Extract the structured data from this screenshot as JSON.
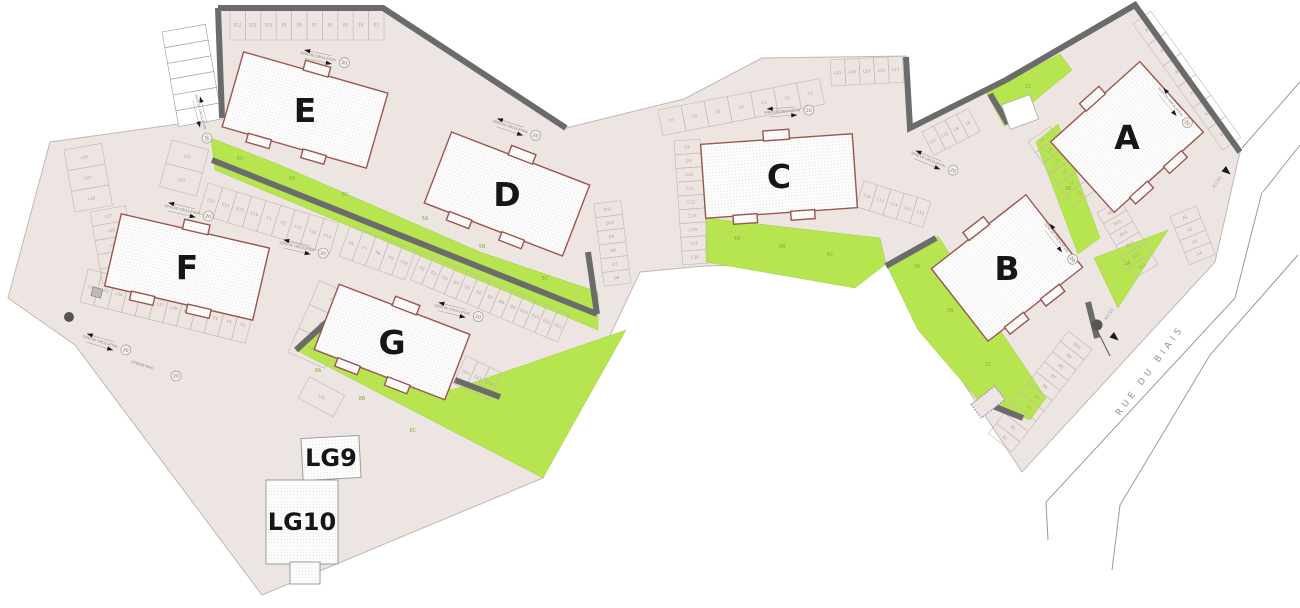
{
  "plan": {
    "street_name": "RUE DU BIAIS",
    "circulation_label": "SENS DE CIRCULATION",
    "speed_limit": "20",
    "speed_note": "VITESSE MAXI",
    "access_label": "ACCES",
    "buildings": [
      {
        "id": "E",
        "label": "E"
      },
      {
        "id": "D",
        "label": "D"
      },
      {
        "id": "F",
        "label": "F"
      },
      {
        "id": "G",
        "label": "G"
      },
      {
        "id": "C",
        "label": "C"
      },
      {
        "id": "B",
        "label": "B"
      },
      {
        "id": "A",
        "label": "A"
      },
      {
        "id": "LG9",
        "label": "LG9"
      },
      {
        "id": "LG10",
        "label": "LG10"
      }
    ],
    "green_zones": [
      "6A",
      "6B",
      "6C",
      "5A",
      "5B",
      "5C",
      "8A",
      "8B",
      "8C",
      "4A",
      "4B",
      "4C",
      "3A",
      "3B",
      "3C",
      "2C",
      "2B",
      "2A"
    ],
    "parking_rows": [
      {
        "name": "row-e-top",
        "labels": [
          "E12",
          "E11",
          "E10",
          "E9",
          "E8",
          "E7",
          "E6",
          "E5",
          "E4",
          "E3"
        ]
      },
      {
        "name": "row-visitor-white",
        "labels": [
          "",
          "",
          "",
          "",
          "",
          ""
        ]
      },
      {
        "name": "row-l22",
        "labels": [
          "L22",
          "L23"
        ]
      },
      {
        "name": "row-l24",
        "labels": [
          "L24",
          "L25",
          "L26"
        ]
      },
      {
        "name": "row-l27",
        "labels": [
          "L27",
          "L28",
          "L29",
          "L30",
          "L31"
        ]
      },
      {
        "name": "row-f-south",
        "labels": [
          "L32",
          "L33",
          "L34",
          "L35",
          "L36",
          "L37",
          "L38",
          "L39",
          "L40",
          "F5",
          "F4",
          "F3"
        ]
      },
      {
        "name": "row-ef",
        "labels": [
          "E13",
          "E14",
          "E15",
          "E16",
          "F1",
          "F2",
          "F11",
          "F12",
          "F13"
        ]
      },
      {
        "name": "row-f-mid",
        "labels": [
          "F6",
          "F7",
          "F8",
          "F9",
          "F10"
        ]
      },
      {
        "name": "row-g",
        "labels": [
          "G1",
          "G2",
          "G3",
          "G4",
          "G5",
          "G6",
          "G7",
          "G8",
          "G9",
          "G10",
          "G11",
          "G12",
          "G13"
        ]
      },
      {
        "name": "row-f14",
        "labels": [
          "F14",
          "F15",
          "F16"
        ]
      },
      {
        "name": "row-g14",
        "labels": [
          "G14",
          "G15",
          "G16"
        ]
      },
      {
        "name": "row-d",
        "labels": [
          "D11",
          "D10",
          "D9",
          "D8",
          "D7",
          "D6"
        ]
      },
      {
        "name": "row-c-col",
        "labels": [
          "C8",
          "C9",
          "C10",
          "C11",
          "C12",
          "C13",
          "C14",
          "C15",
          "C16"
        ]
      },
      {
        "name": "row-c-top",
        "labels": [
          "C7",
          "C6",
          "C5",
          "C4",
          "C3",
          "C2",
          "C1"
        ]
      },
      {
        "name": "row-l17",
        "labels": [
          "L21",
          "L20",
          "L19",
          "L18",
          "L17"
        ]
      },
      {
        "name": "row-l12",
        "labels": [
          "L16",
          "L15",
          "L14",
          "L13",
          "L12"
        ]
      },
      {
        "name": "row-l8",
        "labels": [
          "L11",
          "L10",
          "L9",
          "L8"
        ]
      },
      {
        "name": "row-l1",
        "labels": [
          "L6",
          "L5",
          "L4",
          "L3",
          "L2",
          "L1"
        ]
      },
      {
        "name": "row-b16",
        "labels": [
          "B16",
          "B15",
          "B14",
          "B13",
          "B12",
          "B11"
        ]
      },
      {
        "name": "row-a-top",
        "labels": [
          "A15",
          "A14",
          "A13",
          "A12",
          "A11",
          "A10"
        ]
      },
      {
        "name": "row-a1",
        "labels": [
          "A1",
          "A2",
          "A3",
          "A4"
        ]
      },
      {
        "name": "row-b-road",
        "labels": [
          "B1",
          "B2",
          "B3",
          "B4",
          "B5",
          "B6",
          "B7",
          "B8",
          "B9",
          "B10"
        ]
      },
      {
        "name": "row-l41",
        "labels": [
          "L41"
        ]
      }
    ],
    "colors": {
      "parcel": "#ece5e2",
      "green": "#b7e550",
      "wall": "#6b6b6b",
      "building_stroke": "#9b564d",
      "road_line": "#9a9a9a",
      "accent_purple": "#a183cf"
    }
  }
}
